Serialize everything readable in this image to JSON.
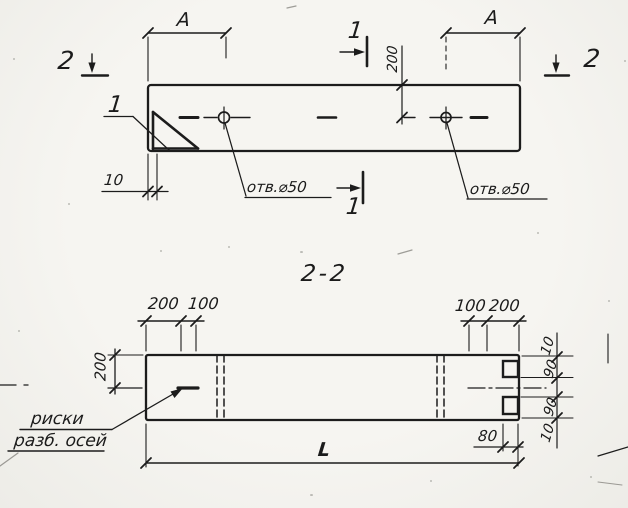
{
  "drawing": {
    "top_view": {
      "section_cut_1_top": "1",
      "section_cut_1_bottom": "1",
      "section_cut_2_left": "2",
      "section_cut_2_right": "2",
      "dim_span_left": "A",
      "dim_span_right": "A",
      "dim_hole_offset": "200",
      "dim_wall_thickness": "10",
      "hole_left_label": "отв.⌀50",
      "hole_right_label": "отв.⌀50",
      "corner_detail_ref": "1"
    },
    "section_view": {
      "title": "2-2",
      "dim_left_outer": "200",
      "dim_left_inner": "100",
      "dim_right_inner": "100",
      "dim_right_outer": "200",
      "dim_half_height": "200",
      "dim_length": "L",
      "dim_end_offset": "80",
      "right_chain": [
        "10",
        "90",
        "90",
        "10"
      ],
      "axes_label_line1": "риски",
      "axes_label_line2": "разб. осей"
    },
    "line_color": "#1c1c1c"
  }
}
